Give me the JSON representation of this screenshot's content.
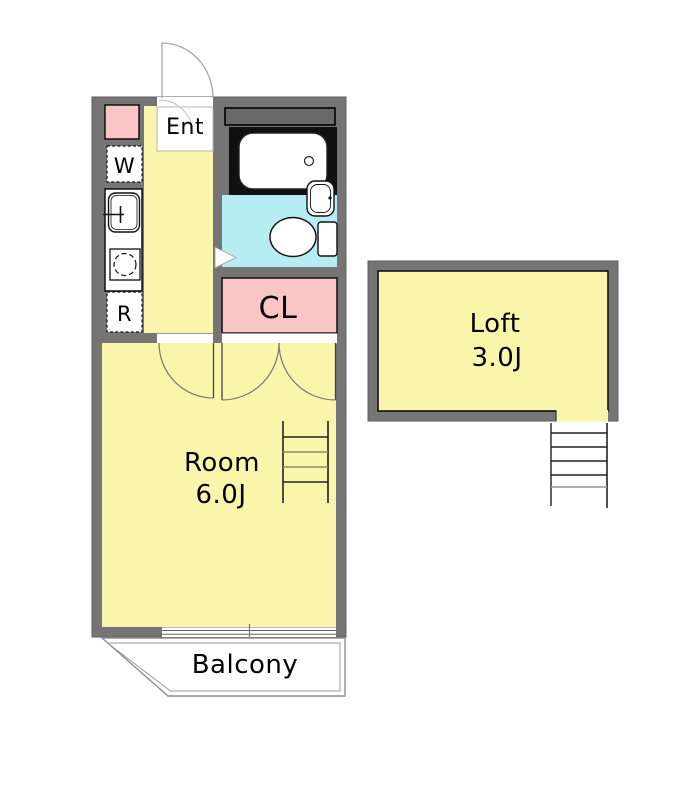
{
  "floorplan": {
    "entrance": {
      "label": "Ent"
    },
    "washer": {
      "label": "W"
    },
    "fridge": {
      "label": "R"
    },
    "closet": {
      "label": "CL"
    },
    "room": {
      "label": "Room",
      "size": "6.0J"
    },
    "loft": {
      "label": "Loft",
      "size": "3.0J"
    },
    "balcony": {
      "label": "Balcony"
    }
  },
  "colors": {
    "wall_gray": "#757575",
    "duct_gray": "#696969",
    "floor_yellow": "#F9F6AB",
    "closet_pink": "#F9C5C5",
    "bath_cyan": "#B5EDF3",
    "tub_zone_black": "#101010",
    "fixture_white": "#FFFFFF",
    "label_text": "#000000"
  }
}
